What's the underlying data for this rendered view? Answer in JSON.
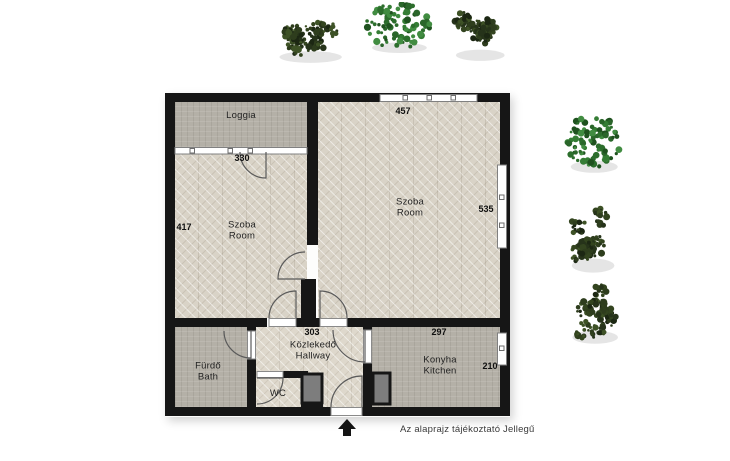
{
  "rooms": {
    "loggia": {
      "label": "Loggia"
    },
    "room_left": {
      "label_hu": "Szoba",
      "label_en": "Room",
      "dim_top": "330",
      "dim_side": "417"
    },
    "room_right": {
      "label_hu": "Szoba",
      "label_en": "Room",
      "dim_top": "457",
      "dim_side": "535"
    },
    "hallway": {
      "label_hu": "Közlekedő",
      "label_en": "Hallway",
      "dim_top": "303"
    },
    "bath": {
      "label_hu": "Fürdő",
      "label_en": "Bath"
    },
    "wc": {
      "label": "WC"
    },
    "kitchen": {
      "label_hu": "Konyha",
      "label_en": "Kitchen",
      "dim_top": "297",
      "dim_side": "210"
    }
  },
  "caption": "Az alaprajz tájékoztató Jellegű",
  "colors": {
    "wall": "#161616",
    "parquet_floor": "#d9d3c7",
    "stone_floor": "#b4b0a7",
    "shaft_fill": "#7d7d7d",
    "window_fill": "#ffffff",
    "door_arc": "#5a5a5a",
    "tree_palettes": {
      "bushy": [
        "#26331a",
        "#33441f",
        "#1c2713",
        "#3e5226",
        "#2e3d1d"
      ],
      "round": [
        "#2a662a",
        "#357d35",
        "#1f521f",
        "#418c41",
        "#2c6e2c"
      ]
    }
  },
  "trees": [
    {
      "variant": "bushy"
    },
    {
      "variant": "round"
    },
    {
      "variant": "bushy"
    },
    {
      "variant": "round"
    },
    {
      "variant": "bushy"
    },
    {
      "variant": "bushy"
    }
  ]
}
